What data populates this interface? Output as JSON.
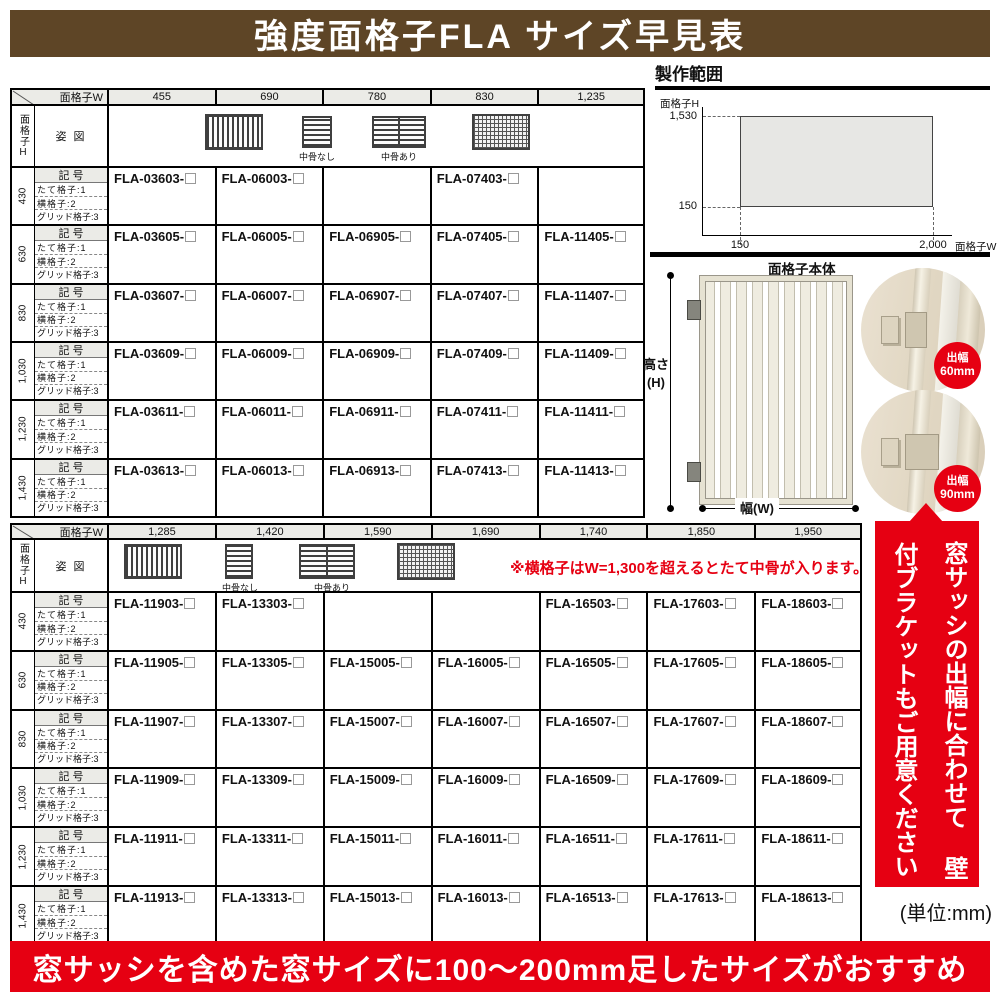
{
  "title": "強度面格子FLA サイズ早見表",
  "bottom_banner": "窓サッシを含めた窓サイズに100〜200mm足したサイズがおすすめ",
  "side_banner": {
    "line1": "窓サッシの出幅に合わせて",
    "line2": "壁付ブラケットもご用意ください"
  },
  "unit_note": "(単位:mm)",
  "legend": {
    "corner_w": "面格子W",
    "corner_h": "面格子H",
    "shape_label": "姿 図",
    "code_label": "記 号",
    "type_labels": [
      "たて格子:1",
      "横格子:2",
      "グリッド格子:3"
    ],
    "nakabone_nashi": "中骨なし",
    "nakabone_ari": "中骨あり"
  },
  "production_range": {
    "title": "製作範囲",
    "y_axis_label": "面格子H",
    "x_axis_label": "面格子W",
    "y_max": "1,530",
    "y_min": "150",
    "x_min": "150",
    "x_max": "2,000"
  },
  "product_diagram": {
    "label": "面格子本体",
    "height_label": "高さ",
    "height_sub": "(H)",
    "width_label": "幅(W)",
    "badges": [
      {
        "line1": "出幅",
        "line2": "60mm"
      },
      {
        "line1": "出幅",
        "line2": "90mm"
      }
    ]
  },
  "table1": {
    "widths": [
      "455",
      "690",
      "780",
      "830",
      "1,235"
    ],
    "rows": [
      {
        "height": "430",
        "codes": [
          "FLA-03603-",
          "FLA-06003-",
          "",
          "FLA-07403-",
          ""
        ]
      },
      {
        "height": "630",
        "codes": [
          "FLA-03605-",
          "FLA-06005-",
          "FLA-06905-",
          "FLA-07405-",
          "FLA-11405-"
        ]
      },
      {
        "height": "830",
        "codes": [
          "FLA-03607-",
          "FLA-06007-",
          "FLA-06907-",
          "FLA-07407-",
          "FLA-11407-"
        ]
      },
      {
        "height": "1,030",
        "codes": [
          "FLA-03609-",
          "FLA-06009-",
          "FLA-06909-",
          "FLA-07409-",
          "FLA-11409-"
        ]
      },
      {
        "height": "1,230",
        "codes": [
          "FLA-03611-",
          "FLA-06011-",
          "FLA-06911-",
          "FLA-07411-",
          "FLA-11411-"
        ]
      },
      {
        "height": "1,430",
        "codes": [
          "FLA-03613-",
          "FLA-06013-",
          "FLA-06913-",
          "FLA-07413-",
          "FLA-11413-"
        ]
      }
    ]
  },
  "table2": {
    "note": "※横格子はW=1,300を超えるとたて中骨が入ります。",
    "widths": [
      "1,285",
      "1,420",
      "1,590",
      "1,690",
      "1,740",
      "1,850",
      "1,950"
    ],
    "rows": [
      {
        "height": "430",
        "codes": [
          "FLA-11903-",
          "FLA-13303-",
          "",
          "",
          "FLA-16503-",
          "FLA-17603-",
          "FLA-18603-"
        ]
      },
      {
        "height": "630",
        "codes": [
          "FLA-11905-",
          "FLA-13305-",
          "FLA-15005-",
          "FLA-16005-",
          "FLA-16505-",
          "FLA-17605-",
          "FLA-18605-"
        ]
      },
      {
        "height": "830",
        "codes": [
          "FLA-11907-",
          "FLA-13307-",
          "FLA-15007-",
          "FLA-16007-",
          "FLA-16507-",
          "FLA-17607-",
          "FLA-18607-"
        ]
      },
      {
        "height": "1,030",
        "codes": [
          "FLA-11909-",
          "FLA-13309-",
          "FLA-15009-",
          "FLA-16009-",
          "FLA-16509-",
          "FLA-17609-",
          "FLA-18609-"
        ]
      },
      {
        "height": "1,230",
        "codes": [
          "FLA-11911-",
          "FLA-13311-",
          "FLA-15011-",
          "FLA-16011-",
          "FLA-16511-",
          "FLA-17611-",
          "FLA-18611-"
        ]
      },
      {
        "height": "1,430",
        "codes": [
          "FLA-11913-",
          "FLA-13313-",
          "FLA-15013-",
          "FLA-16013-",
          "FLA-16513-",
          "FLA-17613-",
          "FLA-18613-"
        ]
      }
    ]
  },
  "colors": {
    "brown": "#5e4526",
    "red": "#e60012",
    "header_bg": "#ebebe7"
  }
}
